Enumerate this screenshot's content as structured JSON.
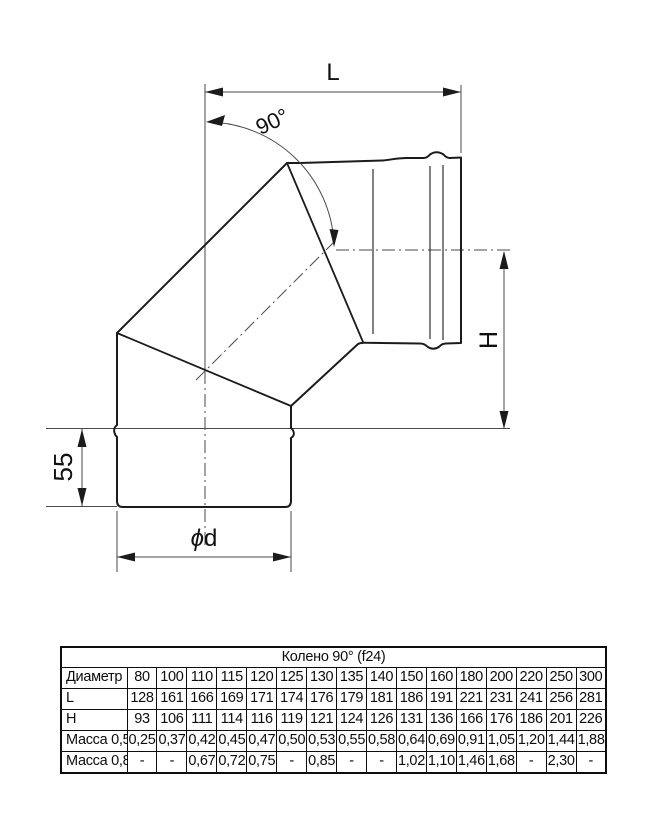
{
  "diagram": {
    "labels": {
      "length": "L",
      "angle": "90°",
      "height": "H",
      "socket": "55",
      "diameter_symbol": "ϕ",
      "diameter_letter": "d"
    }
  },
  "table": {
    "title": "Колено 90° (f24)",
    "header_label": "Диаметр",
    "header_values": [
      "80",
      "100",
      "110",
      "115",
      "120",
      "125",
      "130",
      "135",
      "140",
      "150",
      "160",
      "180",
      "200",
      "220",
      "250",
      "300"
    ],
    "rows": [
      {
        "label": "L",
        "values": [
          "128",
          "161",
          "166",
          "169",
          "171",
          "174",
          "176",
          "179",
          "181",
          "186",
          "191",
          "221",
          "231",
          "241",
          "256",
          "281"
        ]
      },
      {
        "label": "H",
        "values": [
          "93",
          "106",
          "111",
          "114",
          "116",
          "119",
          "121",
          "124",
          "126",
          "131",
          "136",
          "166",
          "176",
          "186",
          "201",
          "226"
        ]
      },
      {
        "label": "Масса 0,5",
        "values": [
          "0,25",
          "0,37",
          "0,42",
          "0,45",
          "0,47",
          "0,50",
          "0,53",
          "0,55",
          "0,58",
          "0,64",
          "0,69",
          "0,91",
          "1,05",
          "1,20",
          "1,44",
          "1,88"
        ]
      },
      {
        "label": "Масса 0,8",
        "values": [
          "-",
          "-",
          "0,67",
          "0,72",
          "0,75",
          "-",
          "0,85",
          "-",
          "-",
          "1,02",
          "1,10",
          "1,46",
          "1,68",
          "-",
          "2,30",
          "-"
        ]
      }
    ]
  }
}
